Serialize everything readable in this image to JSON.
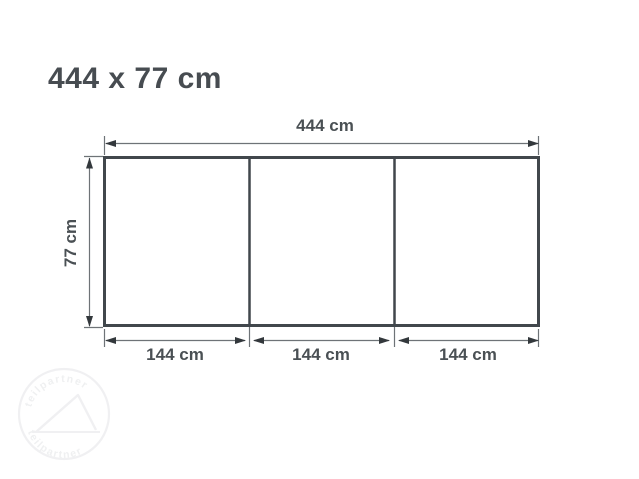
{
  "title": "444 x 77 cm",
  "diagram": {
    "overall_width_label": "444 cm",
    "overall_height_label": "77 cm",
    "section_labels": [
      "144 cm",
      "144 cm",
      "144 cm"
    ],
    "num_sections": 3,
    "colors": {
      "outline": "#41474c",
      "dimension_line": "#6e7377",
      "arrowhead": "#33383c",
      "label_text": "#4a5054",
      "title_text": "#474c51",
      "watermark": "#eff0f1"
    }
  },
  "watermark": {
    "arc_text_top": "teilpartner",
    "arc_text_bottom": "teilpartner"
  }
}
